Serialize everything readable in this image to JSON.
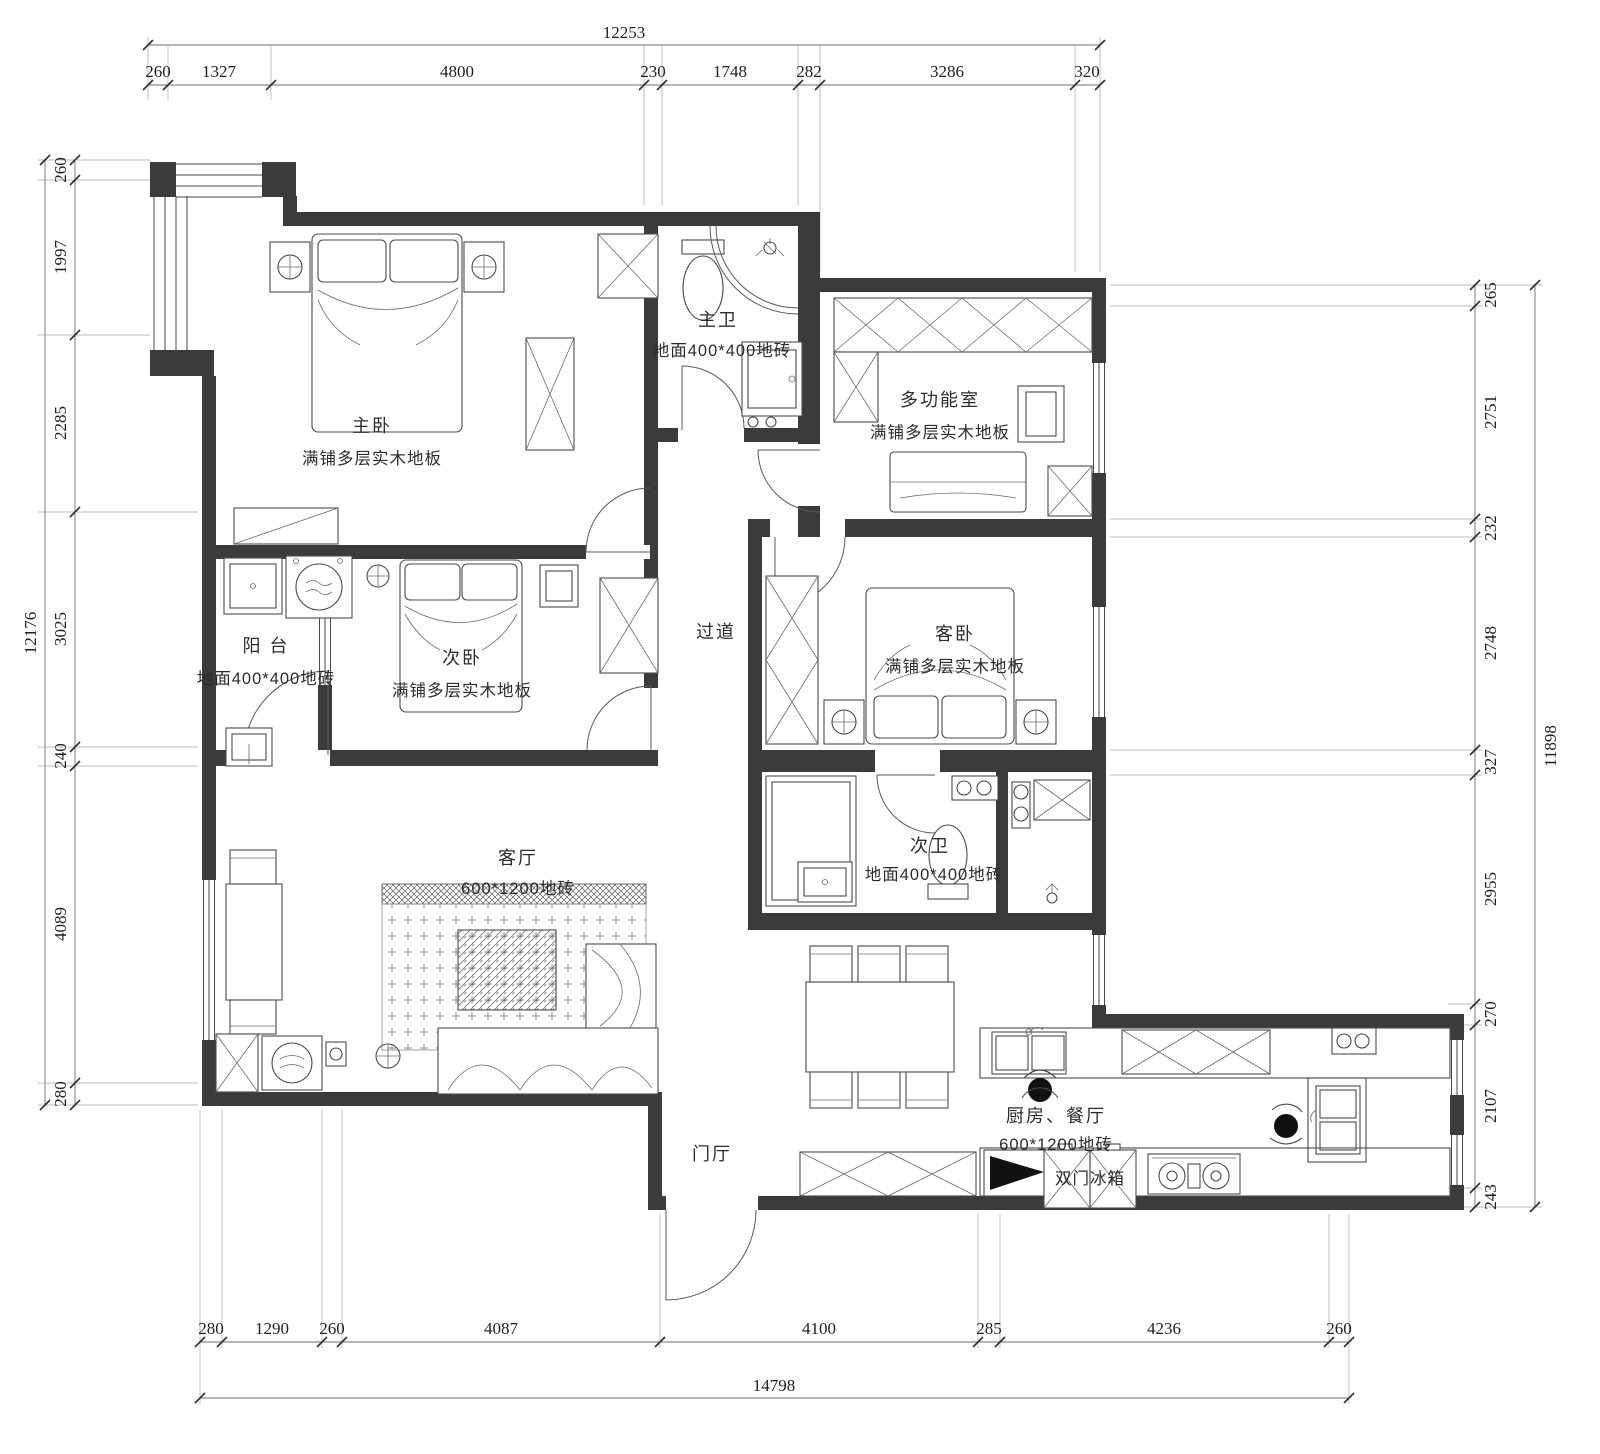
{
  "plan": {
    "rooms": {
      "master_bedroom": {
        "name": "主卧",
        "floor": "满铺多层实木地板"
      },
      "master_bath": {
        "name": "主卫",
        "floor": "地面400*400地砖"
      },
      "multi_function": {
        "name": "多功能室",
        "floor": "满铺多层实木地板"
      },
      "balcony": {
        "name": "阳 台",
        "floor": "地面400*400地砖"
      },
      "second_bedroom": {
        "name": "次卧",
        "floor": "满铺多层实木地板"
      },
      "corridor": {
        "name": "过道"
      },
      "guest_bedroom": {
        "name": "客卧",
        "floor": "满铺多层实木地板"
      },
      "living_room": {
        "name": "客厅",
        "floor": "600*1200地砖"
      },
      "second_bath": {
        "name": "次卫",
        "floor": "地面400*400地砖"
      },
      "kitchen_dining": {
        "name": "厨房、餐厅",
        "floor": "600*1200地砖"
      },
      "entry": {
        "name": "门厅"
      }
    },
    "appliances": {
      "fridge": "双门冰箱"
    },
    "dimensions": {
      "top": {
        "total": "12253",
        "segments": [
          "260",
          "1327",
          "4800",
          "230",
          "1748",
          "282",
          "3286",
          "320"
        ]
      },
      "bottom": {
        "total": "14798",
        "segments": [
          "280",
          "1290",
          "260",
          "4087",
          "4100",
          "285",
          "4236",
          "260"
        ]
      },
      "left": {
        "total": "12176",
        "segments": [
          "260",
          "1997",
          "2285",
          "3025",
          "240",
          "4089",
          "280"
        ]
      },
      "right": {
        "total": "11898",
        "segments": [
          "265",
          "2751",
          "232",
          "2748",
          "327",
          "2955",
          "270",
          "2107",
          "243"
        ]
      }
    },
    "colors": {
      "wall": "#3b3b3b",
      "line": "#4a4a4a",
      "background": "#ffffff"
    }
  }
}
